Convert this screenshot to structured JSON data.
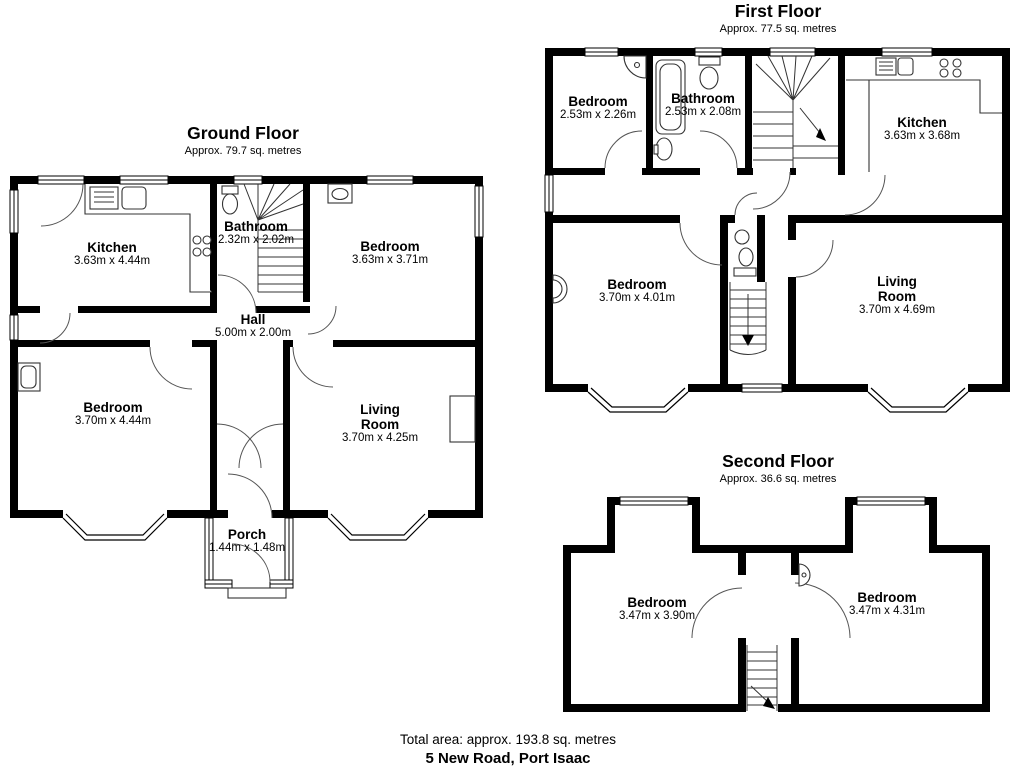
{
  "floors": [
    {
      "title": "Ground Floor",
      "area": "Approx. 79.7 sq. metres",
      "rooms": [
        {
          "name": "Kitchen",
          "dims": "3.63m x 4.44m"
        },
        {
          "name": "Bathroom",
          "dims": "2.32m x 2.02m"
        },
        {
          "name": "Bedroom",
          "dims": "3.63m x 3.71m"
        },
        {
          "name": "Hall",
          "dims": "5.00m x 2.00m"
        },
        {
          "name": "Bedroom",
          "dims": "3.70m x 4.44m"
        },
        {
          "name": "Living Room",
          "dims": "3.70m x 4.25m"
        },
        {
          "name": "Porch",
          "dims": "1.44m x 1.48m"
        }
      ]
    },
    {
      "title": "First Floor",
      "area": "Approx. 77.5 sq. metres",
      "rooms": [
        {
          "name": "Bedroom",
          "dims": "2.53m x 2.26m"
        },
        {
          "name": "Bathroom",
          "dims": "2.53m x 2.08m"
        },
        {
          "name": "Kitchen",
          "dims": "3.63m x 3.68m"
        },
        {
          "name": "Bedroom",
          "dims": "3.70m x 4.01m"
        },
        {
          "name": "Living Room",
          "dims": "3.70m x 4.69m"
        }
      ]
    },
    {
      "title": "Second Floor",
      "area": "Approx. 36.6 sq. metres",
      "rooms": [
        {
          "name": "Bedroom",
          "dims": "3.47m x 3.90m"
        },
        {
          "name": "Bedroom",
          "dims": "3.47m x 4.31m"
        }
      ]
    }
  ],
  "footer": {
    "total_area": "Total area: approx. 193.8 sq. metres",
    "address": "5 New Road, Port Isaac"
  },
  "colors": {
    "wall": "#000000",
    "background": "#ffffff",
    "door_arc": "#555555"
  }
}
